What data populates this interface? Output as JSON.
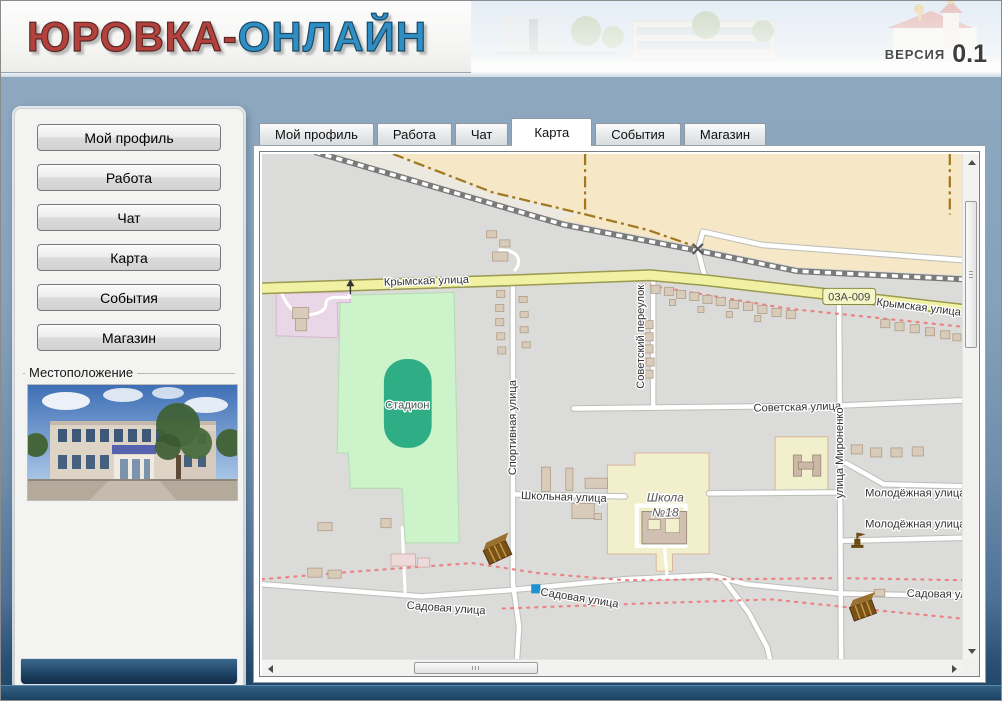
{
  "header": {
    "title_red": "ЮРОВКА-",
    "title_blue": "ОНЛАЙН",
    "version_label": "ВЕРСИЯ",
    "version_number": "0.1"
  },
  "sidebar": {
    "buttons": [
      {
        "label": "Мой профиль"
      },
      {
        "label": "Работа"
      },
      {
        "label": "Чат"
      },
      {
        "label": "Карта"
      },
      {
        "label": "События"
      },
      {
        "label": "Магазин"
      }
    ],
    "location_label": "Местоположение"
  },
  "tabs": [
    {
      "label": "Мой профиль",
      "active": false
    },
    {
      "label": "Работа",
      "active": false
    },
    {
      "label": "Чат",
      "active": false
    },
    {
      "label": "Карта",
      "active": true
    },
    {
      "label": "События",
      "active": false
    },
    {
      "label": "Магазин",
      "active": false
    }
  ],
  "map": {
    "labels": {
      "krymskaya_w": "Крымская улица",
      "krymskaya_e": "Крымская улица",
      "road_ref": "03А-009",
      "sovetskaya": "Советская улица",
      "sovetsky_pereulok": "Советский переулок",
      "sportivnaya": "Спортивная улица",
      "mironenko": "улица Мироненко",
      "shkolnaya": "Школьная улица",
      "molodezhnaya_1": "Молодёжная улица",
      "molodezhnaya_2": "Молодёжная улица",
      "sadovaya_w": "Садовая улица",
      "sadovaya_mid": "Садовая улица",
      "sadovaya_e": "Садовая ул",
      "stadium": "Стадион",
      "school_line1": "Школа",
      "school_line2": "№18"
    }
  },
  "colors": {
    "background_blue_top": "#8ea8c0",
    "background_blue_bottom": "#1d4263",
    "title_red": "#b5413c",
    "title_blue": "#2f8fc5",
    "map_road_yellow": "#f1f1a4",
    "map_pitch_green": "#2fae86",
    "map_green_area": "#ccf3c9",
    "map_beige_area": "#f6e7c6",
    "map_marker_blue": "#1c92d2"
  }
}
